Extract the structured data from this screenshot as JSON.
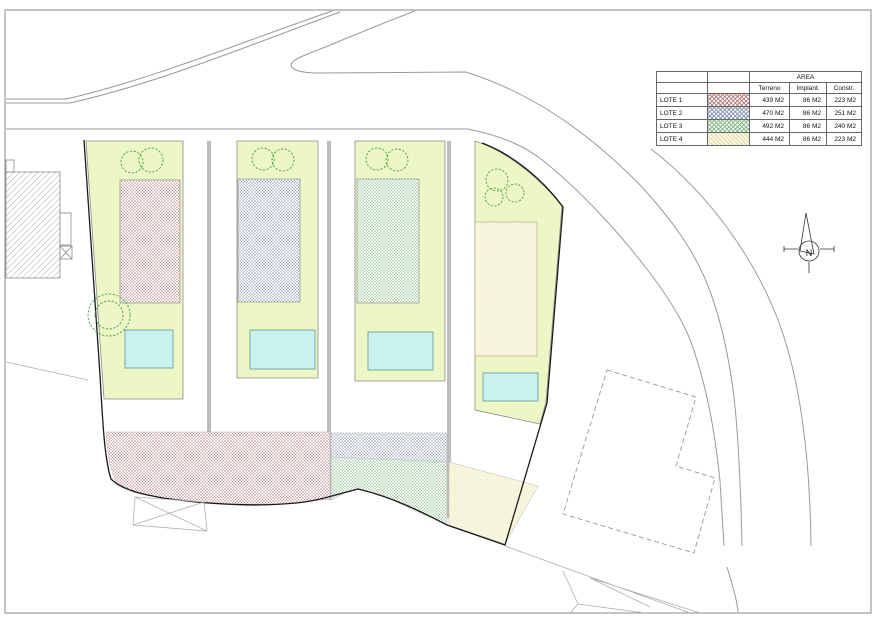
{
  "legend_table": {
    "area_header": "AREA",
    "columns": [
      "Terreno",
      "Implant.",
      "Constr."
    ],
    "rows": [
      {
        "label": "LOTE 1",
        "terreno": "439 M2",
        "implant": "86 M2",
        "constr": "223 M2",
        "swatch_name": "red-crosshatch",
        "swatch_color": "#b27676"
      },
      {
        "label": "LOTE 2",
        "terreno": "470 M2",
        "implant": "86 M2",
        "constr": "251 M2",
        "swatch_name": "blue-crosshatch",
        "swatch_color": "#7d8ca5"
      },
      {
        "label": "LOTE 3",
        "terreno": "492 M2",
        "implant": "86 M2",
        "constr": "240 M2",
        "swatch_name": "green-crosshatch",
        "swatch_color": "#7db47d"
      },
      {
        "label": "LOTE 4",
        "terreno": "444 M2",
        "implant": "86 M2",
        "constr": "223 M2",
        "swatch_name": "yellow-hatch",
        "swatch_color": "#d7cd8c"
      }
    ]
  },
  "compass": {
    "label": "N"
  },
  "palette": {
    "lot_ground": "#edf6c5",
    "pool_fill": "#c9f2ef",
    "tree_stroke": "#44a044",
    "road_line": "#9a9a9a",
    "boundary_line": "#1a1a1a"
  }
}
